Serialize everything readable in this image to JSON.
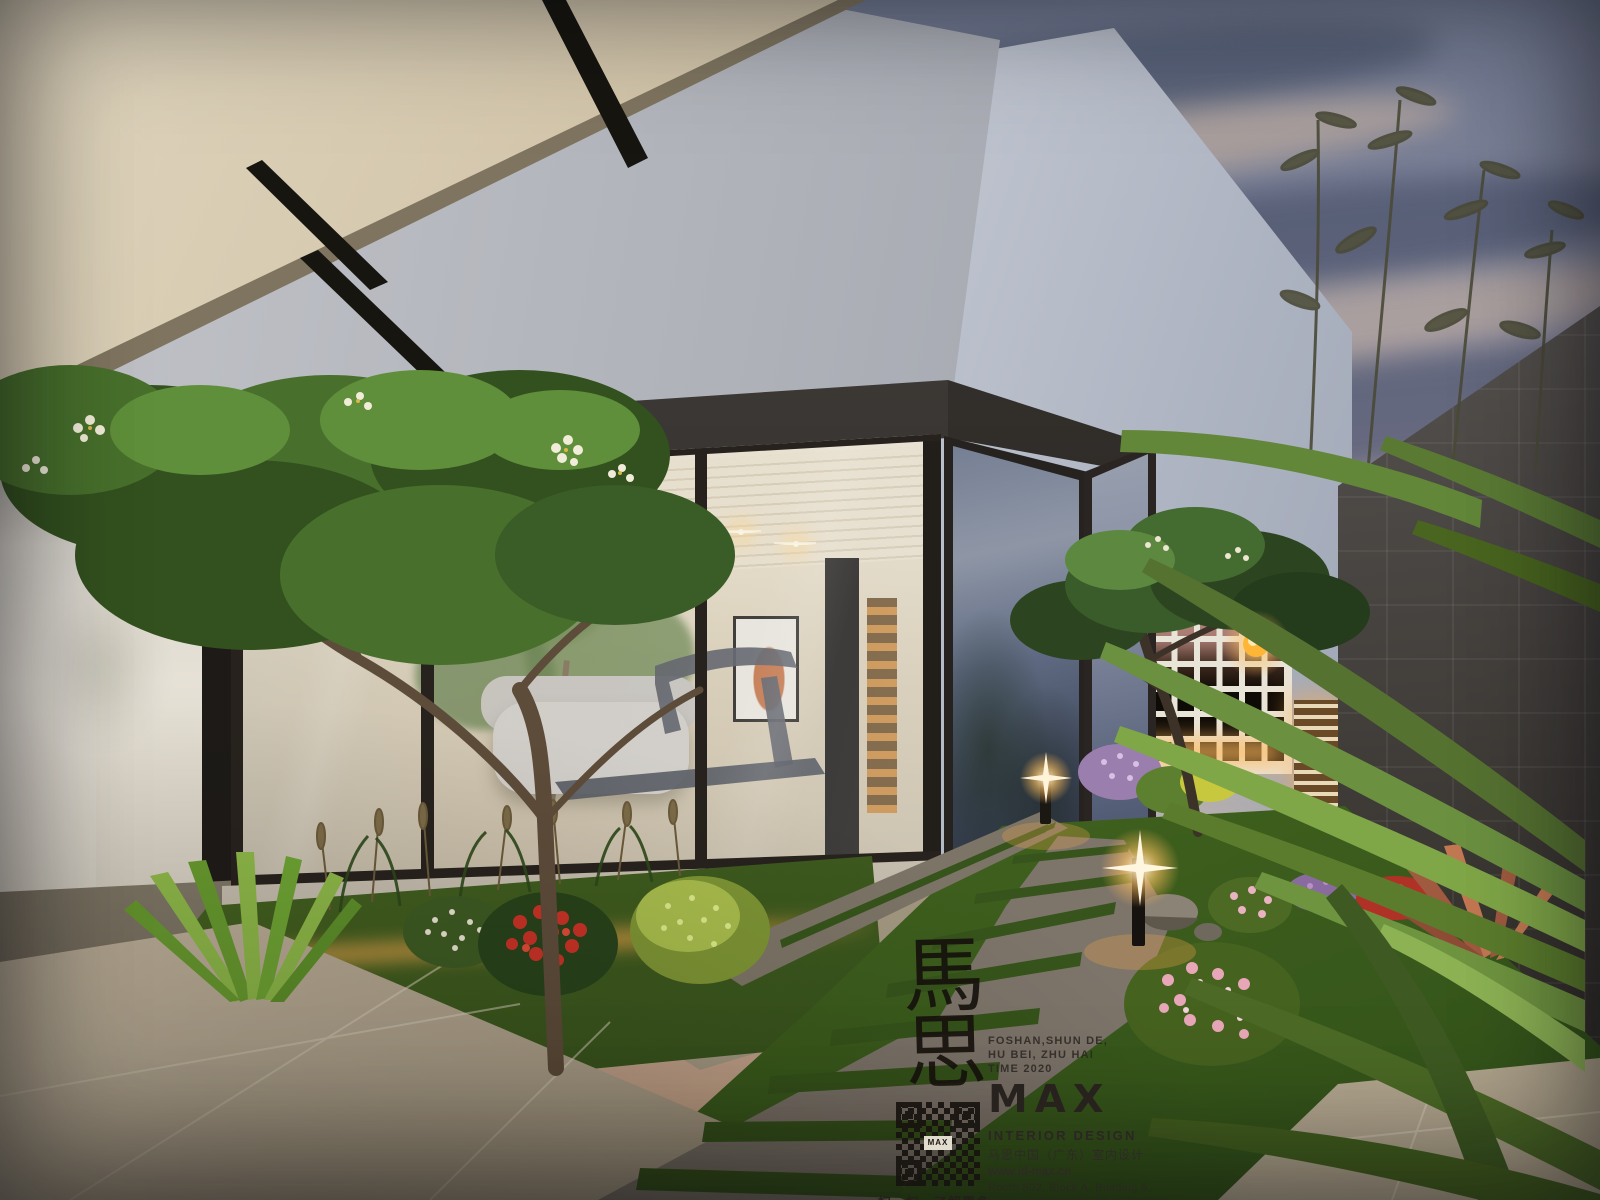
{
  "watermark": {
    "calligraphy_char_top": "馬",
    "calligraphy_char_bottom": "思",
    "tagline_line1": "FOSHAN,SHUN DE,",
    "tagline_line2": "HU BEI, ZHU HAI",
    "tagline_line3": "TIME 2020",
    "logo": "MAX",
    "subtitle": "INTERIOR DESIGN",
    "cn_line": "马思中国（广东）室内设计",
    "website": "www.id-max.cn",
    "address_line1": "Room 802, Block A, Building 5,",
    "address_line2": "Tianan Cyber Park, No.1 Jianping",
    "address_line3": "Road, Guicheng Street, Nanhai",
    "address_line4": "District,Foshan City, Guangdong",
    "address_line5": "Province, China",
    "qr_caption": "扫一扫，了解更多",
    "qr_center_label": "MAX"
  },
  "palette": {
    "sky_top": "#6e7890",
    "sky_horizon_warm": "#caa98c",
    "cloud_dark": "#424c63",
    "cloud_light": "#e2c4a4",
    "canopy_cream": "#d8cdb6",
    "wall_white": "#dfe2e6",
    "frame_dark": "#27221d",
    "interior_warm": "#efe6d2",
    "glow_warm": "#ffc75f",
    "lattice_white": "#e9e4d8",
    "stone_wall_dark": "#4a4744",
    "tile_beige": "#b3a794",
    "path_stone": "#7d746a",
    "grass_green": "#4f7a2e",
    "palm_green": "#6f9440",
    "flower_red": "#c93226",
    "flower_pink": "#e8a7b8",
    "flower_purple": "#b98fc9",
    "frangipani_flower": "#f1ecd9",
    "ink": "#1c1a18"
  }
}
